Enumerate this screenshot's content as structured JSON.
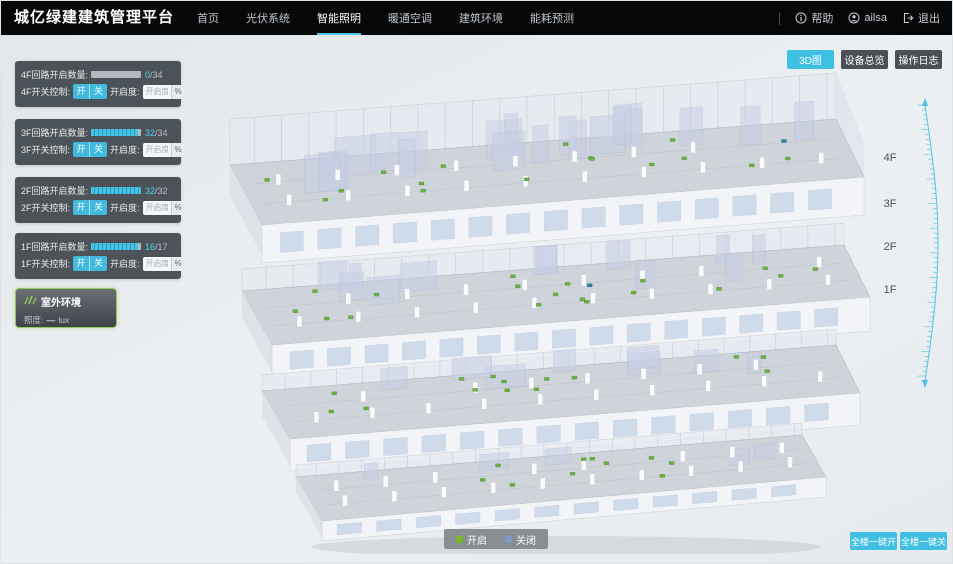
{
  "header": {
    "title": "城亿绿建建筑管理平台",
    "nav": [
      {
        "label": "首页",
        "active": false
      },
      {
        "label": "光伏系统",
        "active": false
      },
      {
        "label": "智能照明",
        "active": true
      },
      {
        "label": "暖通空调",
        "active": false
      },
      {
        "label": "建筑环境",
        "active": false
      },
      {
        "label": "能耗预测",
        "active": false
      }
    ],
    "help_label": "帮助",
    "username": "ailsa",
    "logout_label": "退出"
  },
  "view_toggle": {
    "buttons": [
      {
        "label": "3D图",
        "active": true
      },
      {
        "label": "设备总览",
        "active": false
      },
      {
        "label": "操作日志",
        "active": false
      }
    ]
  },
  "floor_panels": [
    {
      "floor": "4F",
      "count_label": "4F回路开启数量:",
      "open": 0,
      "total": 34,
      "open_label": "0",
      "total_label": "/34",
      "switch_label": "4F开关控制:",
      "on_label": "开",
      "off_label": "关",
      "dim_label": "开启度:",
      "dim_placeholder": "开启度",
      "unit_label": "%"
    },
    {
      "floor": "3F",
      "count_label": "3F回路开启数量:",
      "open": 32,
      "total": 34,
      "open_label": "32",
      "total_label": "/34",
      "switch_label": "3F开关控制:",
      "on_label": "开",
      "off_label": "关",
      "dim_label": "开启度:",
      "dim_placeholder": "开启度",
      "unit_label": "%"
    },
    {
      "floor": "2F",
      "count_label": "2F回路开启数量:",
      "open": 32,
      "total": 32,
      "open_label": "32",
      "total_label": "/32",
      "switch_label": "2F开关控制:",
      "on_label": "开",
      "off_label": "关",
      "dim_label": "开启度:",
      "dim_placeholder": "开启度",
      "unit_label": "%"
    },
    {
      "floor": "1F",
      "count_label": "1F回路开启数量:",
      "open": 16,
      "total": 17,
      "open_label": "16",
      "total_label": "/17",
      "switch_label": "1F开关控制:",
      "on_label": "开",
      "off_label": "关",
      "dim_label": "开启度:",
      "dim_placeholder": "开启度",
      "unit_label": "%"
    }
  ],
  "outdoor_panel": {
    "title": "室外环境",
    "metric_label": "照度:",
    "metric_value": "—",
    "metric_unit": "lux"
  },
  "floor_scale": {
    "labels": [
      "4F",
      "3F",
      "2F",
      "1F"
    ]
  },
  "legend": {
    "items": [
      {
        "label": "开启",
        "color": "#76b82a"
      },
      {
        "label": "关闭",
        "color": "#7e97c9"
      }
    ]
  },
  "bulk_actions": {
    "all_on_label": "全楼一键开",
    "all_off_label": "全楼一键关"
  },
  "colors": {
    "accent": "#3fc0e3",
    "panel_bg": "#373d43",
    "marker_on": "#6ab33e",
    "marker_off": "#2e89a8"
  }
}
